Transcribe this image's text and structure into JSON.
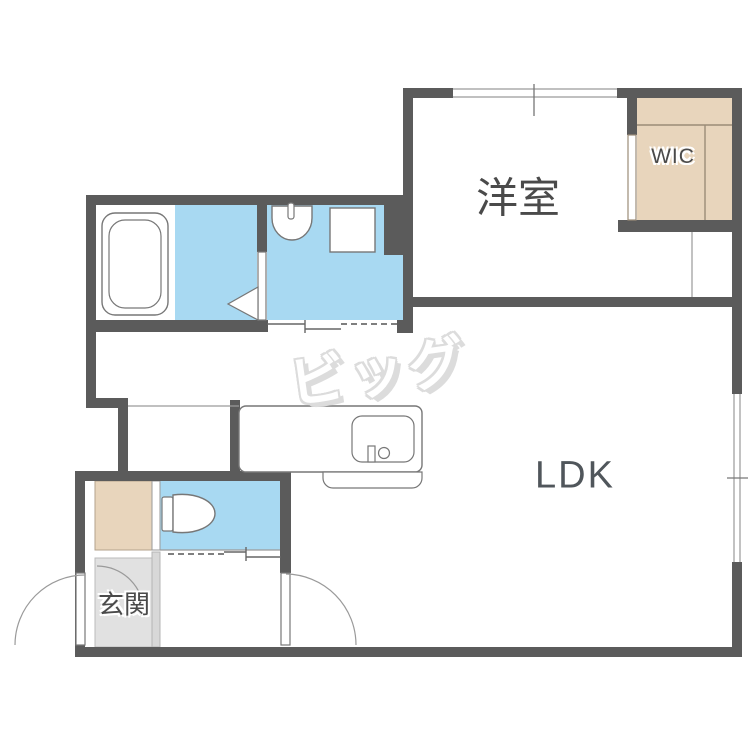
{
  "title": "apartment-floorplan",
  "labels": {
    "bedroom": "洋室",
    "wic": "WIC",
    "ldk": "LDK",
    "entrance": "玄関",
    "watermark": "ビッグ"
  },
  "colors": {
    "wall": "#5b5b5b",
    "water": "#a8d9f2",
    "beige": "#e8d5bc",
    "genkanfloor": "#e1e1e1",
    "stepstrip": "#d8d8d8",
    "stroke": "#777777",
    "shelfline": "#9b8c77",
    "labelcolor": "#4a4a4a",
    "ldkcolor": "#50565b",
    "wm": "#dcdcdc"
  },
  "rooms": [
    {
      "name": "bedroom",
      "label": "洋室"
    },
    {
      "name": "walk-in-closet",
      "label": "WIC"
    },
    {
      "name": "living-dining-kitchen",
      "label": "LDK"
    },
    {
      "name": "entrance",
      "label": "玄関"
    },
    {
      "name": "bathroom",
      "label": ""
    },
    {
      "name": "washroom",
      "label": ""
    },
    {
      "name": "toilet",
      "label": ""
    }
  ]
}
